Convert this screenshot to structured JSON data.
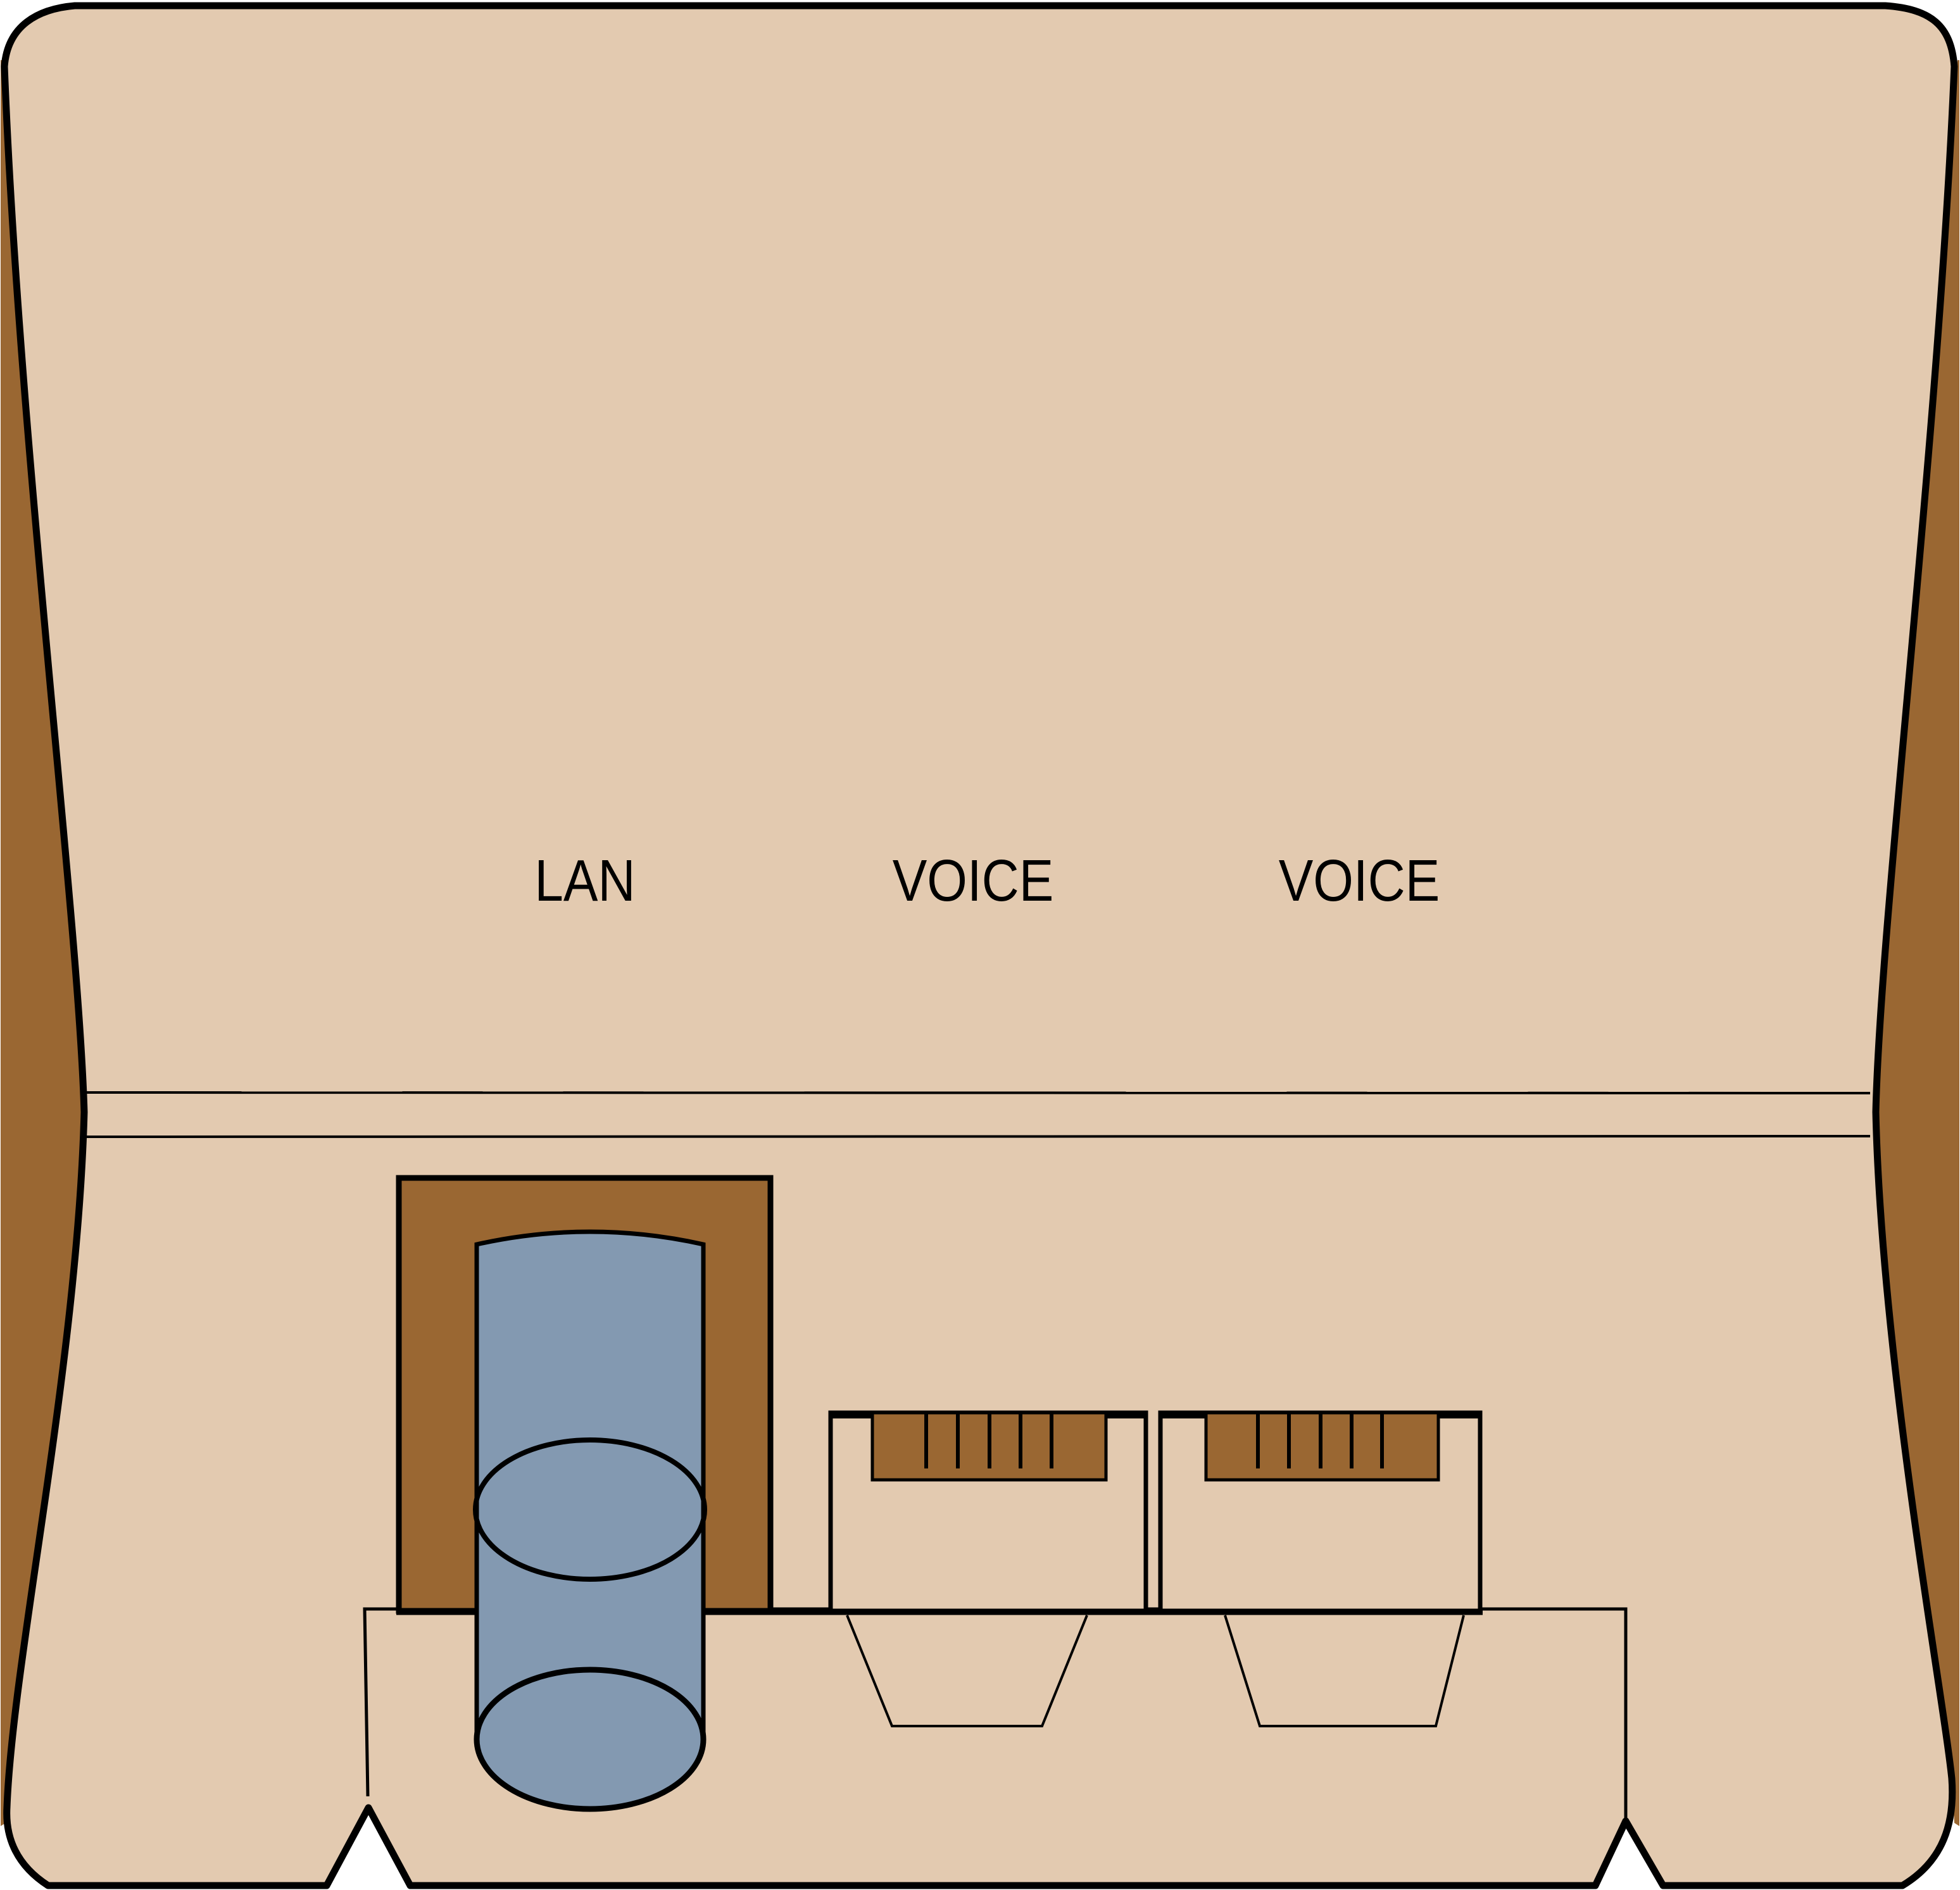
{
  "diagram": {
    "labels": {
      "lan": "LAN",
      "voice_1": "VOICE",
      "voice_2": "VOICE"
    },
    "colors": {
      "background": "#FFFFFF",
      "plate": "#E3CAB0",
      "side_wedge": "#9A6732",
      "port_frame": "#9A6732",
      "connector": "#9A6732",
      "cable": "#8399B1",
      "outline": "#000000"
    }
  }
}
